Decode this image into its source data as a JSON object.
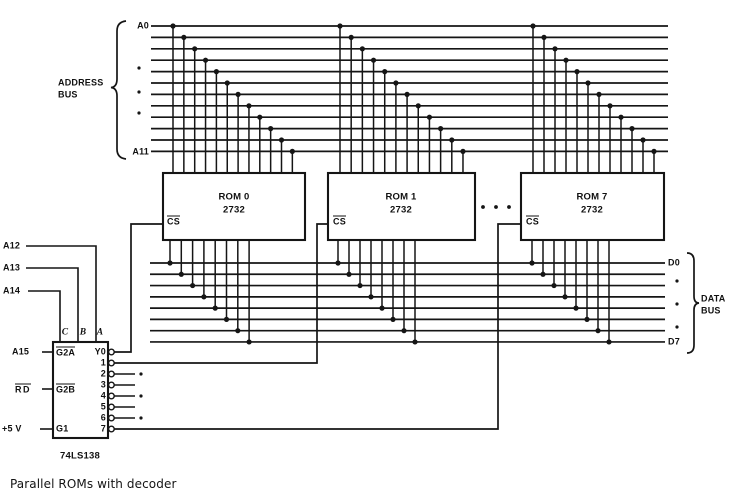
{
  "caption": "Parallel ROMs with decoder",
  "colors": {
    "ink": "#151515",
    "background": "#ffffff"
  },
  "address_bus": {
    "name_lines": [
      "ADDRESS",
      "BUS"
    ],
    "first_line": "A0",
    "last_line": "A11",
    "line_count": 12
  },
  "data_bus": {
    "name_lines": [
      "DATA",
      "BUS"
    ],
    "first_line": "D0",
    "last_line": "D7",
    "line_count": 8
  },
  "roms": [
    {
      "name": "ROM 0",
      "part": "2732",
      "chip_select": "CS"
    },
    {
      "name": "ROM 1",
      "part": "2732",
      "chip_select": "CS"
    },
    {
      "name": "ROM 7",
      "part": "2732",
      "chip_select": "CS"
    }
  ],
  "decoder": {
    "part": "74LS138",
    "address_inputs": [
      {
        "signal": "A12",
        "pin": "A"
      },
      {
        "signal": "A13",
        "pin": "B"
      },
      {
        "signal": "A14",
        "pin": "C"
      }
    ],
    "enable_inputs": [
      {
        "signal": "A15",
        "pin": "G2A"
      },
      {
        "signal": "RD",
        "pin": "G2B"
      },
      {
        "signal": "+5 V",
        "pin": "G1"
      }
    ],
    "outputs": [
      "Y0",
      "1",
      "2",
      "3",
      "4",
      "5",
      "6",
      "7"
    ]
  }
}
